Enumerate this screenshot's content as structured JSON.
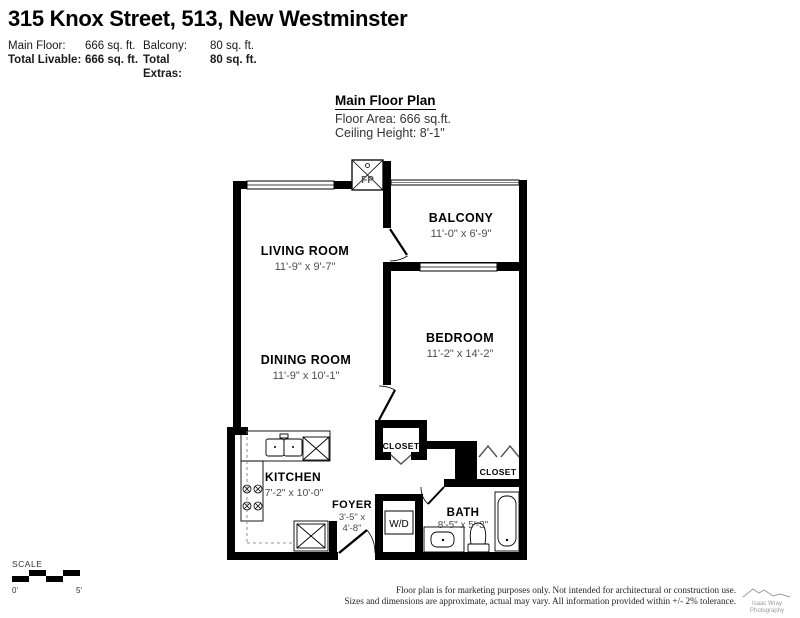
{
  "header": {
    "title": "315 Knox Street, 513, New Westminster",
    "stats": {
      "row1": {
        "label1": "Main Floor:",
        "value1": "666 sq. ft.",
        "label2": "Balcony:",
        "value2": "80 sq. ft."
      },
      "row2": {
        "label1": "Total Livable:",
        "value1": "666 sq. ft.",
        "label2": "Total Extras:",
        "value2": "80 sq. ft."
      }
    }
  },
  "plan_info": {
    "title": "Main Floor Plan",
    "floor_area": "Floor Area: 666 sq.ft.",
    "ceiling_height": "Ceiling Height: 8'-1\""
  },
  "rooms": {
    "living_room": {
      "name": "LIVING ROOM",
      "dims": "11'-9\" x 9'-7\""
    },
    "dining_room": {
      "name": "DINING ROOM",
      "dims": "11'-9\" x 10'-1\""
    },
    "kitchen": {
      "name": "KITCHEN",
      "dims": "7'-2\" x 10'-0\""
    },
    "bedroom": {
      "name": "BEDROOM",
      "dims": "11'-2\" x 14'-2\""
    },
    "balcony": {
      "name": "BALCONY",
      "dims": "11'-0\" x 6'-9\""
    },
    "bath": {
      "name": "BATH",
      "dims": "8'-5\" x 5'-3\""
    },
    "foyer": {
      "name": "FOYER",
      "dims_line1": "3'-5\" x",
      "dims_line2": "4'-8\""
    },
    "closet_foyer": {
      "label": "CLOSET"
    },
    "closet_bedroom": {
      "label": "CLOSET"
    }
  },
  "fixtures": {
    "washer_dryer_label": "W/D",
    "fireplace_label": "FP"
  },
  "scale_bar": {
    "label": "SCALE",
    "start": "0'",
    "end": "5'"
  },
  "footer": {
    "disclaimer_line1": "Floor plan is for marketing purposes only. Not intended for architectural or construction use.",
    "disclaimer_line2": "Sizes and dimensions are approximate, actual may vary. All information provided within +/- 2% tolerance.",
    "logo_line1": "Isaac Wray",
    "logo_line2": "Photography"
  },
  "colors": {
    "wall": "#000000",
    "dim_text": "#4d4d4d",
    "label_text": "#000000",
    "logo_gray": "#9a9a9a"
  }
}
